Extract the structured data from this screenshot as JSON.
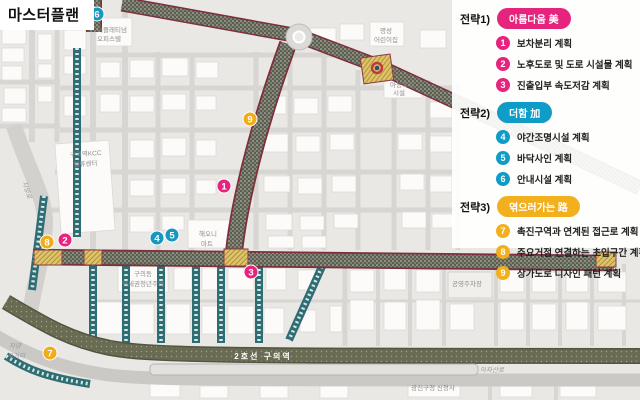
{
  "title": "마스터플랜",
  "colors": {
    "strategy1_pink": "#e6247e",
    "strategy2_blue": "#0f9cc7",
    "strategy3_yellow": "#f2b01e",
    "plan_road_fill": "#5b5f50",
    "plan_road_border": "#7e2f3e",
    "sub_road_teal": "#2f6d75",
    "rail_band": "#6a6d55",
    "intersection_yellow": "#e2c465"
  },
  "legend": {
    "strategies": [
      {
        "label": "전략1)",
        "badge": "아름다움 美",
        "items": [
          {
            "num": "1",
            "text": "보차분리 계획"
          },
          {
            "num": "2",
            "text": "노후도로 및 도로 시설물 계획"
          },
          {
            "num": "3",
            "text": "진출입부 속도저감 계획"
          }
        ]
      },
      {
        "label": "전략2)",
        "badge": "더함 加",
        "items": [
          {
            "num": "4",
            "text": "야간조명시설 계획"
          },
          {
            "num": "5",
            "text": "바닥사인 계획"
          },
          {
            "num": "6",
            "text": "안내시설 계획"
          }
        ]
      },
      {
        "label": "전략3)",
        "badge": "엮으러가는 路",
        "items": [
          {
            "num": "7",
            "text": "촉진구역과 연계된 접근로 계획"
          },
          {
            "num": "8",
            "text": "주요거점 연결하는 초입구간 계획"
          },
          {
            "num": "9",
            "text": "상가도로 디자인 패턴 계획"
          }
        ]
      }
    ]
  },
  "map": {
    "labels": {
      "officetel_1": "더플래티넘",
      "officetel_2": "오피스텔",
      "kindergarten_1": "명성",
      "kindergarten_2": "어린이집",
      "welfare_1": "아동복지",
      "welfare_2": "시설",
      "kcc_1": "구의역KCC",
      "kcc_2": "밸류센터",
      "mart_1": "해오니",
      "mart_2": "마트",
      "youth_1": "구의동",
      "youth_2": "역세권청년주택",
      "parking": "공영주차장",
      "jayang_ro": "자양로",
      "jayang_cross_1": "자양",
      "jayang_cross_2": "사거리",
      "achasan_ro": "아차산로",
      "gu_office": "광진구청 신청사",
      "station": "2호선 구의역"
    },
    "badges": [
      {
        "num": "6",
        "color": "blue"
      },
      {
        "num": "9",
        "color": "yellow"
      },
      {
        "num": "1",
        "color": "pink"
      },
      {
        "num": "2",
        "color": "pink"
      },
      {
        "num": "8",
        "color": "yellow"
      },
      {
        "num": "4",
        "color": "blue"
      },
      {
        "num": "5",
        "color": "blue"
      },
      {
        "num": "3",
        "color": "pink"
      },
      {
        "num": "7",
        "color": "yellow"
      }
    ]
  }
}
